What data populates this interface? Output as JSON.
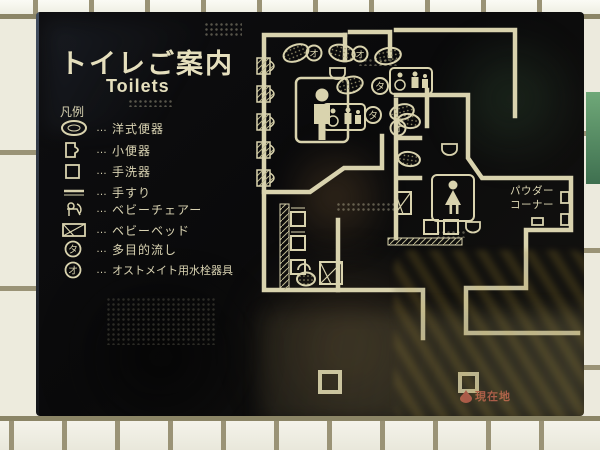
{
  "sign": {
    "title_jp": "トイレご案内",
    "title_en": "Toilets",
    "legend": {
      "heading": "凡例",
      "leader": "…",
      "items": [
        {
          "icon": "western-toilet-icon",
          "label": "洋式便器"
        },
        {
          "icon": "urinal-icon",
          "label": "小便器"
        },
        {
          "icon": "wash-basin-icon",
          "label": "手洗器"
        },
        {
          "icon": "handrail-icon",
          "label": "手すり"
        },
        {
          "icon": "baby-chair-icon",
          "label": "ベビーチェアー"
        },
        {
          "icon": "baby-bed-icon",
          "label": "ベビーベッド"
        },
        {
          "icon": "multipurpose-sink-icon",
          "label": "多目的流し"
        },
        {
          "icon": "ostomate-fixture-icon",
          "label": "オストメイト用水栓器具"
        }
      ]
    },
    "map": {
      "powder_corner_line1": "パウダー",
      "powder_corner_line2": "コーナー",
      "current_location": "現在地",
      "glyph_ta": "タ",
      "glyph_o": "オ"
    },
    "colors": {
      "panel": "#0b0b0c",
      "line": "#d9d3ae",
      "accent_red": "#c05048",
      "tile": "#edebdd",
      "grout": "#9a9376"
    }
  }
}
